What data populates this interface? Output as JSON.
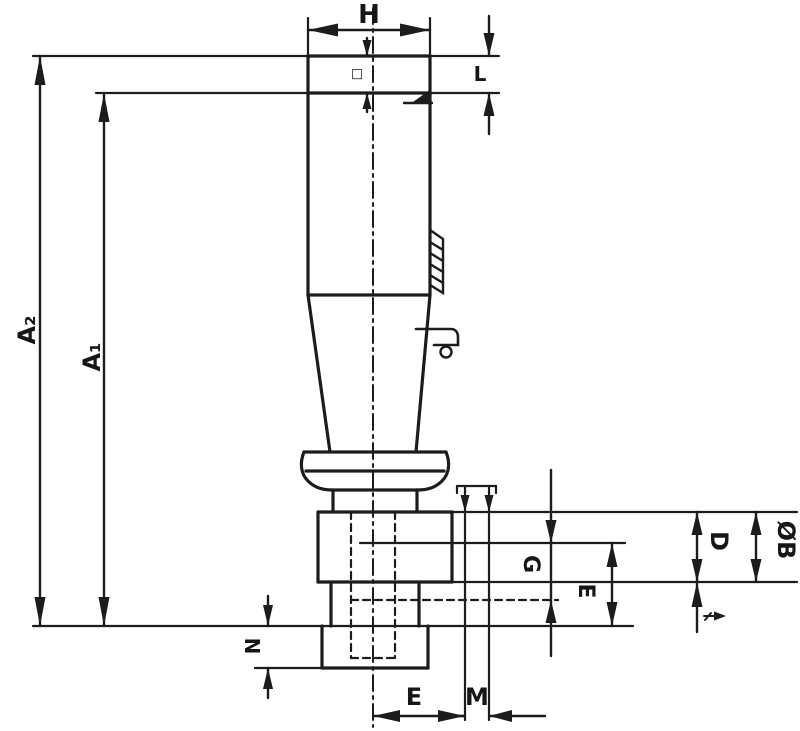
{
  "drawing": {
    "background_color": "#ffffff",
    "line_color": "#1c1c1c",
    "labels": {
      "width_top": "H",
      "square_height": "L",
      "length_overall": "A₂",
      "length_shank": "A₁",
      "square_symbol": "□",
      "depth_g": "G",
      "depth_e": "E",
      "height_d": "D",
      "diameter_b": "ØB",
      "flange_n": "N",
      "offset_e": "E",
      "width_m": "M"
    },
    "icons": {
      "travel_arrow": "→",
      "chamfer_mark": "◢"
    }
  }
}
